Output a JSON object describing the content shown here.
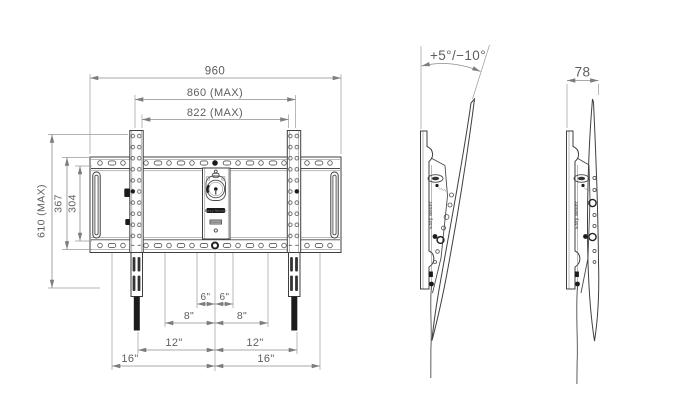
{
  "drawing_type": "tv-wall-mount-dimension-drawing",
  "brand": "Easy Mount",
  "front_view": {
    "dims": {
      "overall_width": "960",
      "max_width": "860 (MAX)",
      "inner_max_width": "822 (MAX)",
      "overall_height": "610 (MAX)",
      "plate_height": "367",
      "inner_height": "304",
      "spacing_6_left": "6\"",
      "spacing_6_right": "6\"",
      "spacing_8_left": "8\"",
      "spacing_8_right": "8\"",
      "spacing_12_left": "12\"",
      "spacing_12_right": "12\"",
      "spacing_16_left": "16\"",
      "spacing_16_right": "16\""
    }
  },
  "side_view_tilted": {
    "tilt_angle": "+5°/−10°"
  },
  "side_view_straight": {
    "depth": "78"
  },
  "colors": {
    "background": "#ffffff",
    "part_line": "#3f3f3f",
    "dimension_line": "#8c8c8c",
    "dimension_text": "#5e5e5e",
    "dark_fill": "#1b1b1b"
  }
}
